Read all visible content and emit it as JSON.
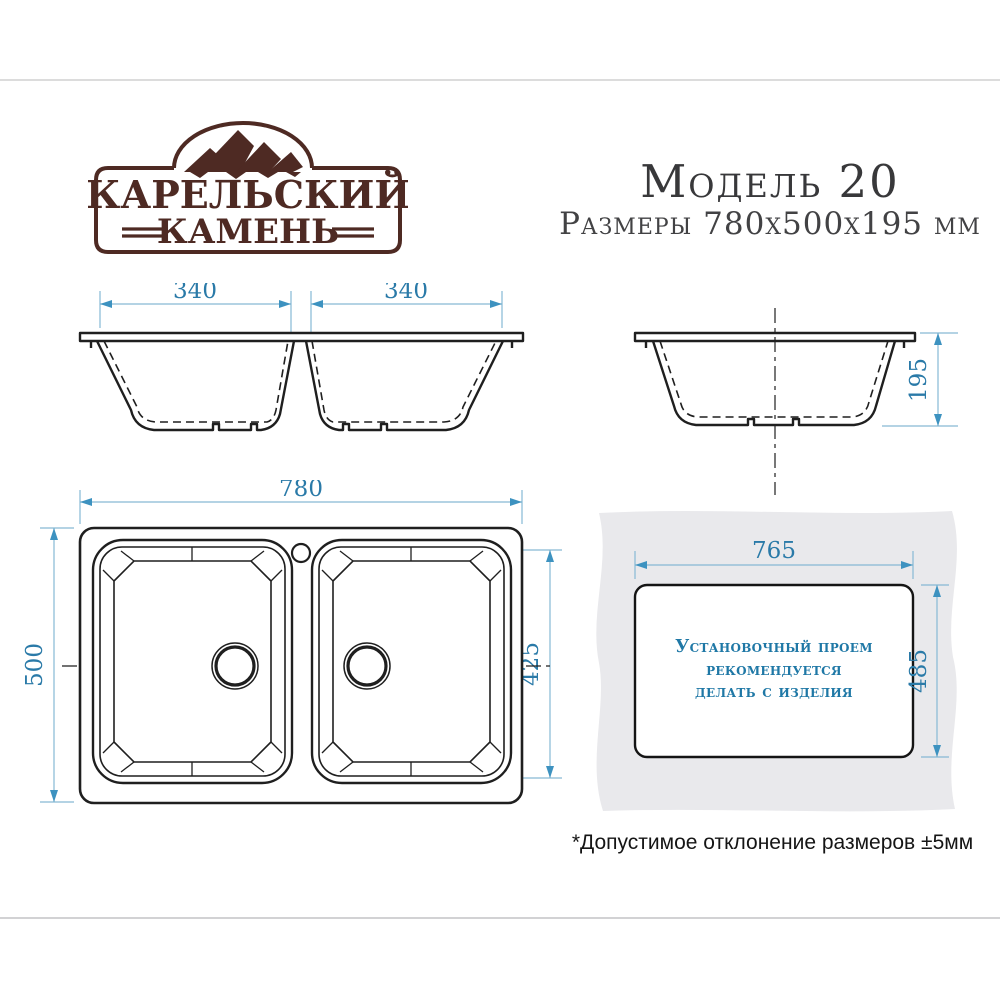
{
  "brand": {
    "name_line1": "КАРЕЛЬСКИЙ",
    "name_line2": "КАМЕНЬ"
  },
  "header": {
    "model": "Модель 20",
    "size_line": "Размеры 780х500х195 мм"
  },
  "front_view": {
    "left_bowl_width_mm": "340",
    "right_bowl_width_mm": "340"
  },
  "side_view": {
    "height_mm": "195"
  },
  "top_view": {
    "overall_width_mm": "780",
    "overall_depth_mm": "500",
    "bowl_length_mm": "425"
  },
  "cutout_view": {
    "cutout_width_mm": "765",
    "cutout_depth_mm": "485",
    "note_line1": "Установочный проем",
    "note_line2": "рекомендуется",
    "note_line3": "делать с изделия"
  },
  "footnote": {
    "tolerance": "*Допустимое отклонение размеров ±5мм"
  },
  "colors": {
    "brand_brown": "#4e2a23",
    "dimension_text_blue": "#2a7aa8",
    "dimension_line_blue": "#86b9d4",
    "arrow_blue": "#3d92c0",
    "outline_black": "#1f1f1f",
    "countertop_gray": "#e9e9ec",
    "note_blue": "#1f78a6"
  }
}
